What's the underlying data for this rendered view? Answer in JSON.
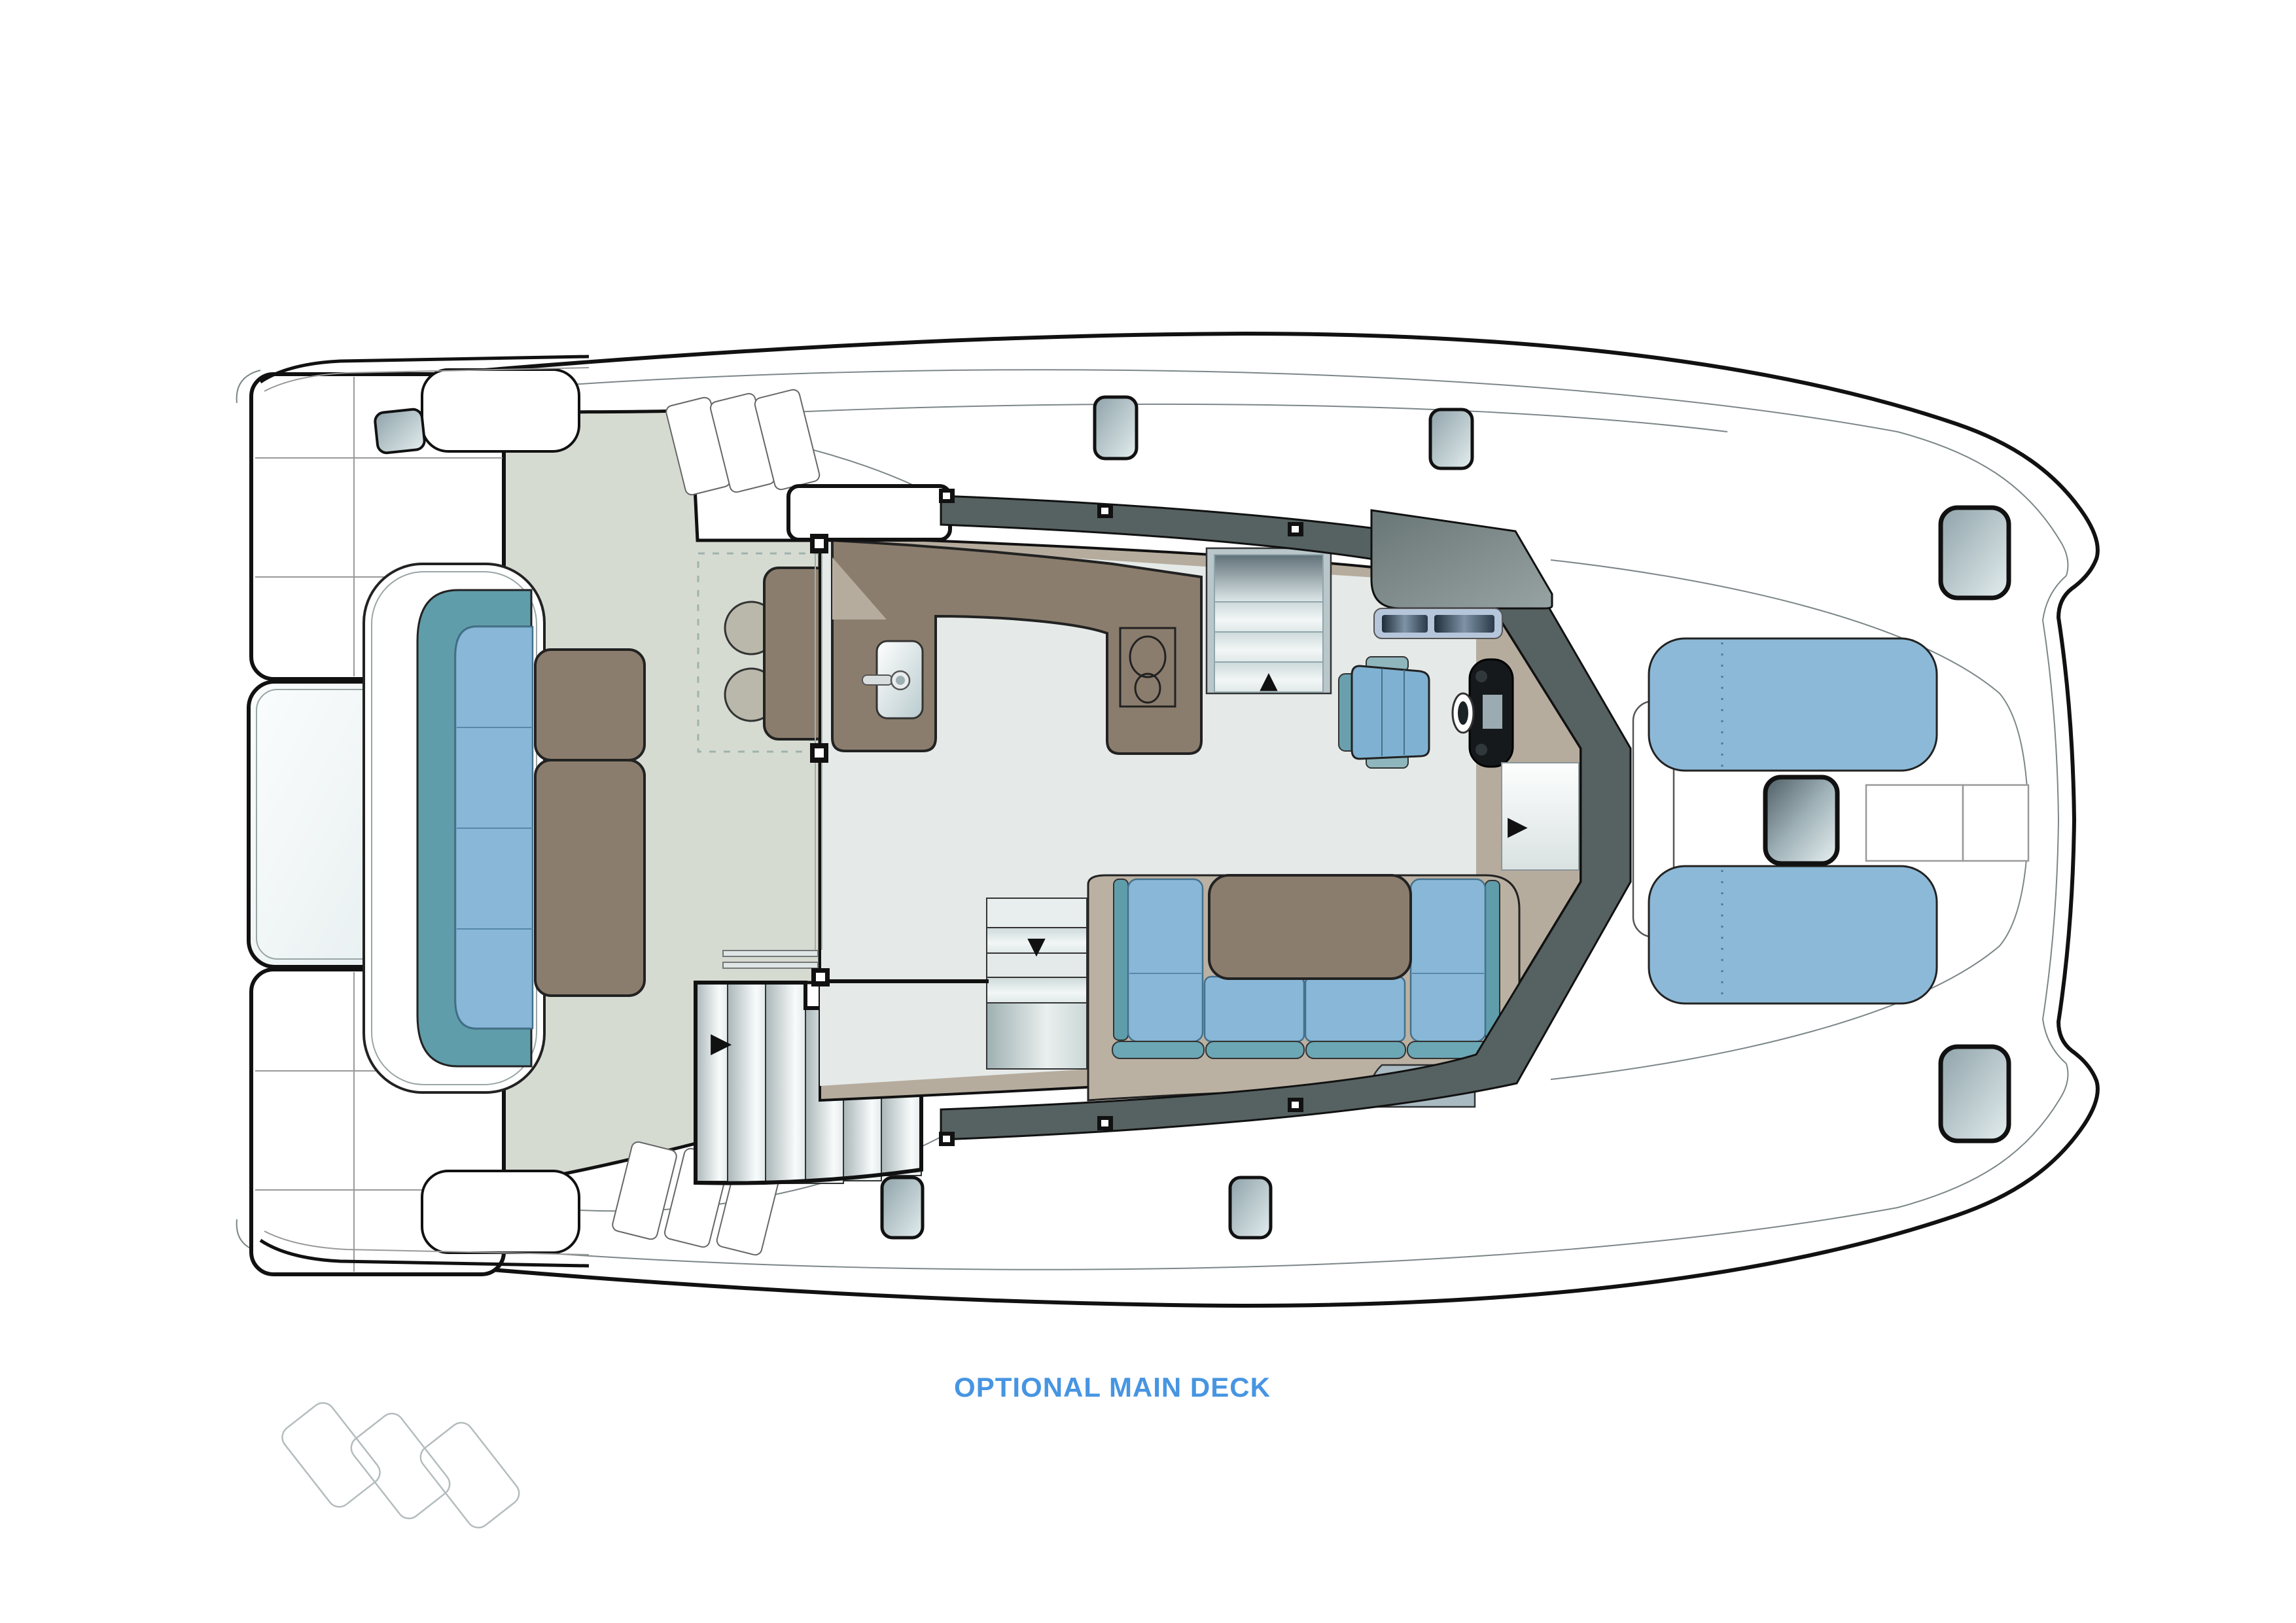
{
  "title": {
    "text": "OPTIONAL MAIN DECK",
    "color": "#4795e2"
  },
  "drawing": {
    "type": "catamaran-main-deck-floor-plan",
    "orientation": "bow-right-stern-left-top-view",
    "icons": {
      "stairs_arrow": "▶",
      "entry_door_arrow": "▶",
      "fridge_up_arrow": "▲",
      "cooler_down_arrow": "▼",
      "freezer_asterisk": "*",
      "freezer_asterisk_count": 3
    },
    "palette": {
      "outline": "#111111",
      "thin_line": "#8a9597",
      "cockpit_floor": "#d6dbd2",
      "salon_floor": "#e5eae8",
      "cabinetry_brown": "#8b7d6d",
      "counter_tan": "#b6ac9e",
      "sofa_base_taupe": "#bbb1a3",
      "cushion_blue": "#89b7d8",
      "cushion_teal": "#5f9dab",
      "cushion_lip_teal": "#6ba7b5",
      "sunpad_blue": "#8cb9d7",
      "helm_seat_blue": "#7fb1d2",
      "windshield_dark": "#566161",
      "stool_beige": "#b9b8aa",
      "hatch_glass_dark": "#5c6b72",
      "hatch_glass_light": "#e8eef0",
      "screen_dark": "#26343f",
      "label_blue": "#4795e2"
    }
  }
}
